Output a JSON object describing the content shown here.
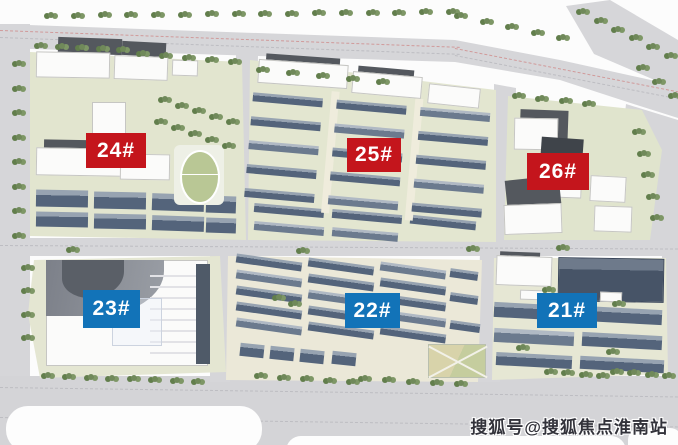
{
  "blocks": [
    {
      "id": "24",
      "label": "24#",
      "color": "#c4151c",
      "group": "red"
    },
    {
      "id": "25",
      "label": "25#",
      "color": "#c4151c",
      "group": "red"
    },
    {
      "id": "26",
      "label": "26#",
      "color": "#c4151c",
      "group": "red"
    },
    {
      "id": "23",
      "label": "23#",
      "color": "#1273b8",
      "group": "blue"
    },
    {
      "id": "22",
      "label": "22#",
      "color": "#1273b8",
      "group": "blue"
    },
    {
      "id": "21",
      "label": "21#",
      "color": "#1273b8",
      "group": "blue"
    }
  ],
  "watermark": {
    "text": "搜狐号@搜狐焦点淮南站",
    "color": "#33333b"
  },
  "palette": {
    "label_red": "#c4151c",
    "label_blue": "#1273b8",
    "road_gray": "#d6d6d9",
    "parcel_ground": "#e3e6d0",
    "building_dark": "#54647b",
    "building_white": "#fbfbfa",
    "tree_green": "#70895a"
  }
}
